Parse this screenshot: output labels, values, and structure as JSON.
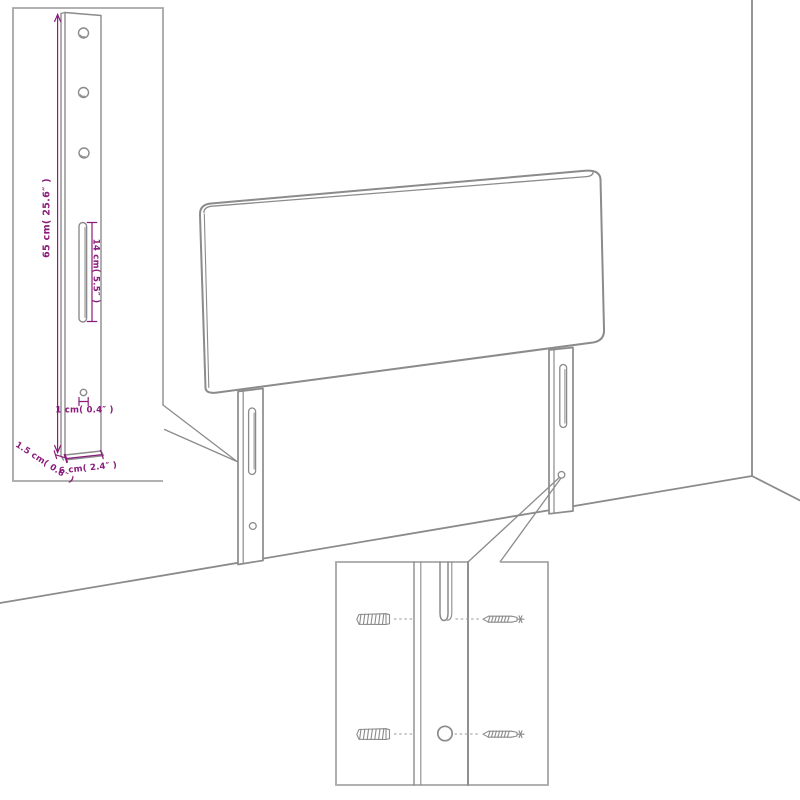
{
  "diagram": {
    "colors": {
      "background": "#ffffff",
      "outline": "#8b8b8b",
      "inset_border": "#a6a6a6",
      "dimension": "#8a1c7c"
    },
    "bracket_inset": {
      "labels": {
        "height": "65 cm( 25.6″ )",
        "slot": "14 cm( 5.5″ )",
        "hole": "1 cm( 0.4″ )",
        "thickness": "1.5 cm( 0.6″ )",
        "width": "6 cm( 2.4″ )"
      }
    }
  }
}
